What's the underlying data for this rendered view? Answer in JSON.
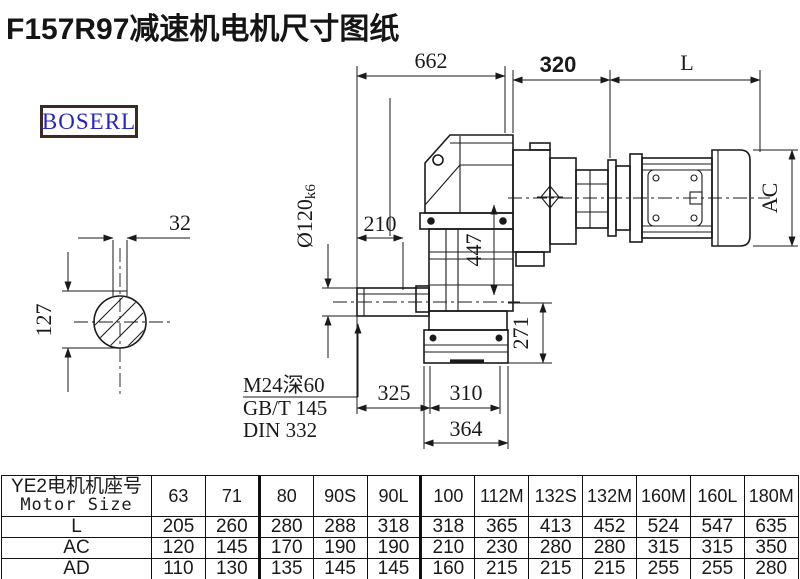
{
  "title": "F157R97减速机电机尺寸图纸",
  "logo": "BOSERL",
  "drawing": {
    "dims": {
      "overall_length": "662",
      "adapter_length": "320",
      "motor_length_label": "L",
      "key_width": "32",
      "key_height": "127",
      "shaft_dia": "Ø120",
      "shaft_dia_tol": "k6",
      "shaft_ext": "210",
      "center_height": "447",
      "output_height": "271",
      "foot_left": "325",
      "foot_right": "310",
      "flange_width": "364",
      "motor_height_label": "AC"
    },
    "notes": [
      "M24深60",
      "GB/T 145",
      "DIN 332"
    ]
  },
  "table": {
    "header_cn": "YE2电机机座号",
    "header_en": "Motor Size",
    "columns": [
      "63",
      "71",
      "80",
      "90S",
      "90L",
      "100",
      "112M",
      "132S",
      "132M",
      "160M",
      "160L",
      "180M"
    ],
    "rows": [
      {
        "label": "L",
        "values": [
          "205",
          "260",
          "280",
          "288",
          "318",
          "318",
          "365",
          "413",
          "452",
          "524",
          "547",
          "635"
        ]
      },
      {
        "label": "AC",
        "values": [
          "120",
          "145",
          "170",
          "190",
          "190",
          "210",
          "230",
          "280",
          "280",
          "315",
          "315",
          "350"
        ]
      },
      {
        "label": "AD",
        "values": [
          "110",
          "130",
          "135",
          "145",
          "145",
          "160",
          "215",
          "215",
          "215",
          "255",
          "255",
          "280"
        ]
      }
    ]
  },
  "colors": {
    "line": "#1a1a1a",
    "logo_text": "#2524c4",
    "logo_border": "#3b2a26"
  }
}
